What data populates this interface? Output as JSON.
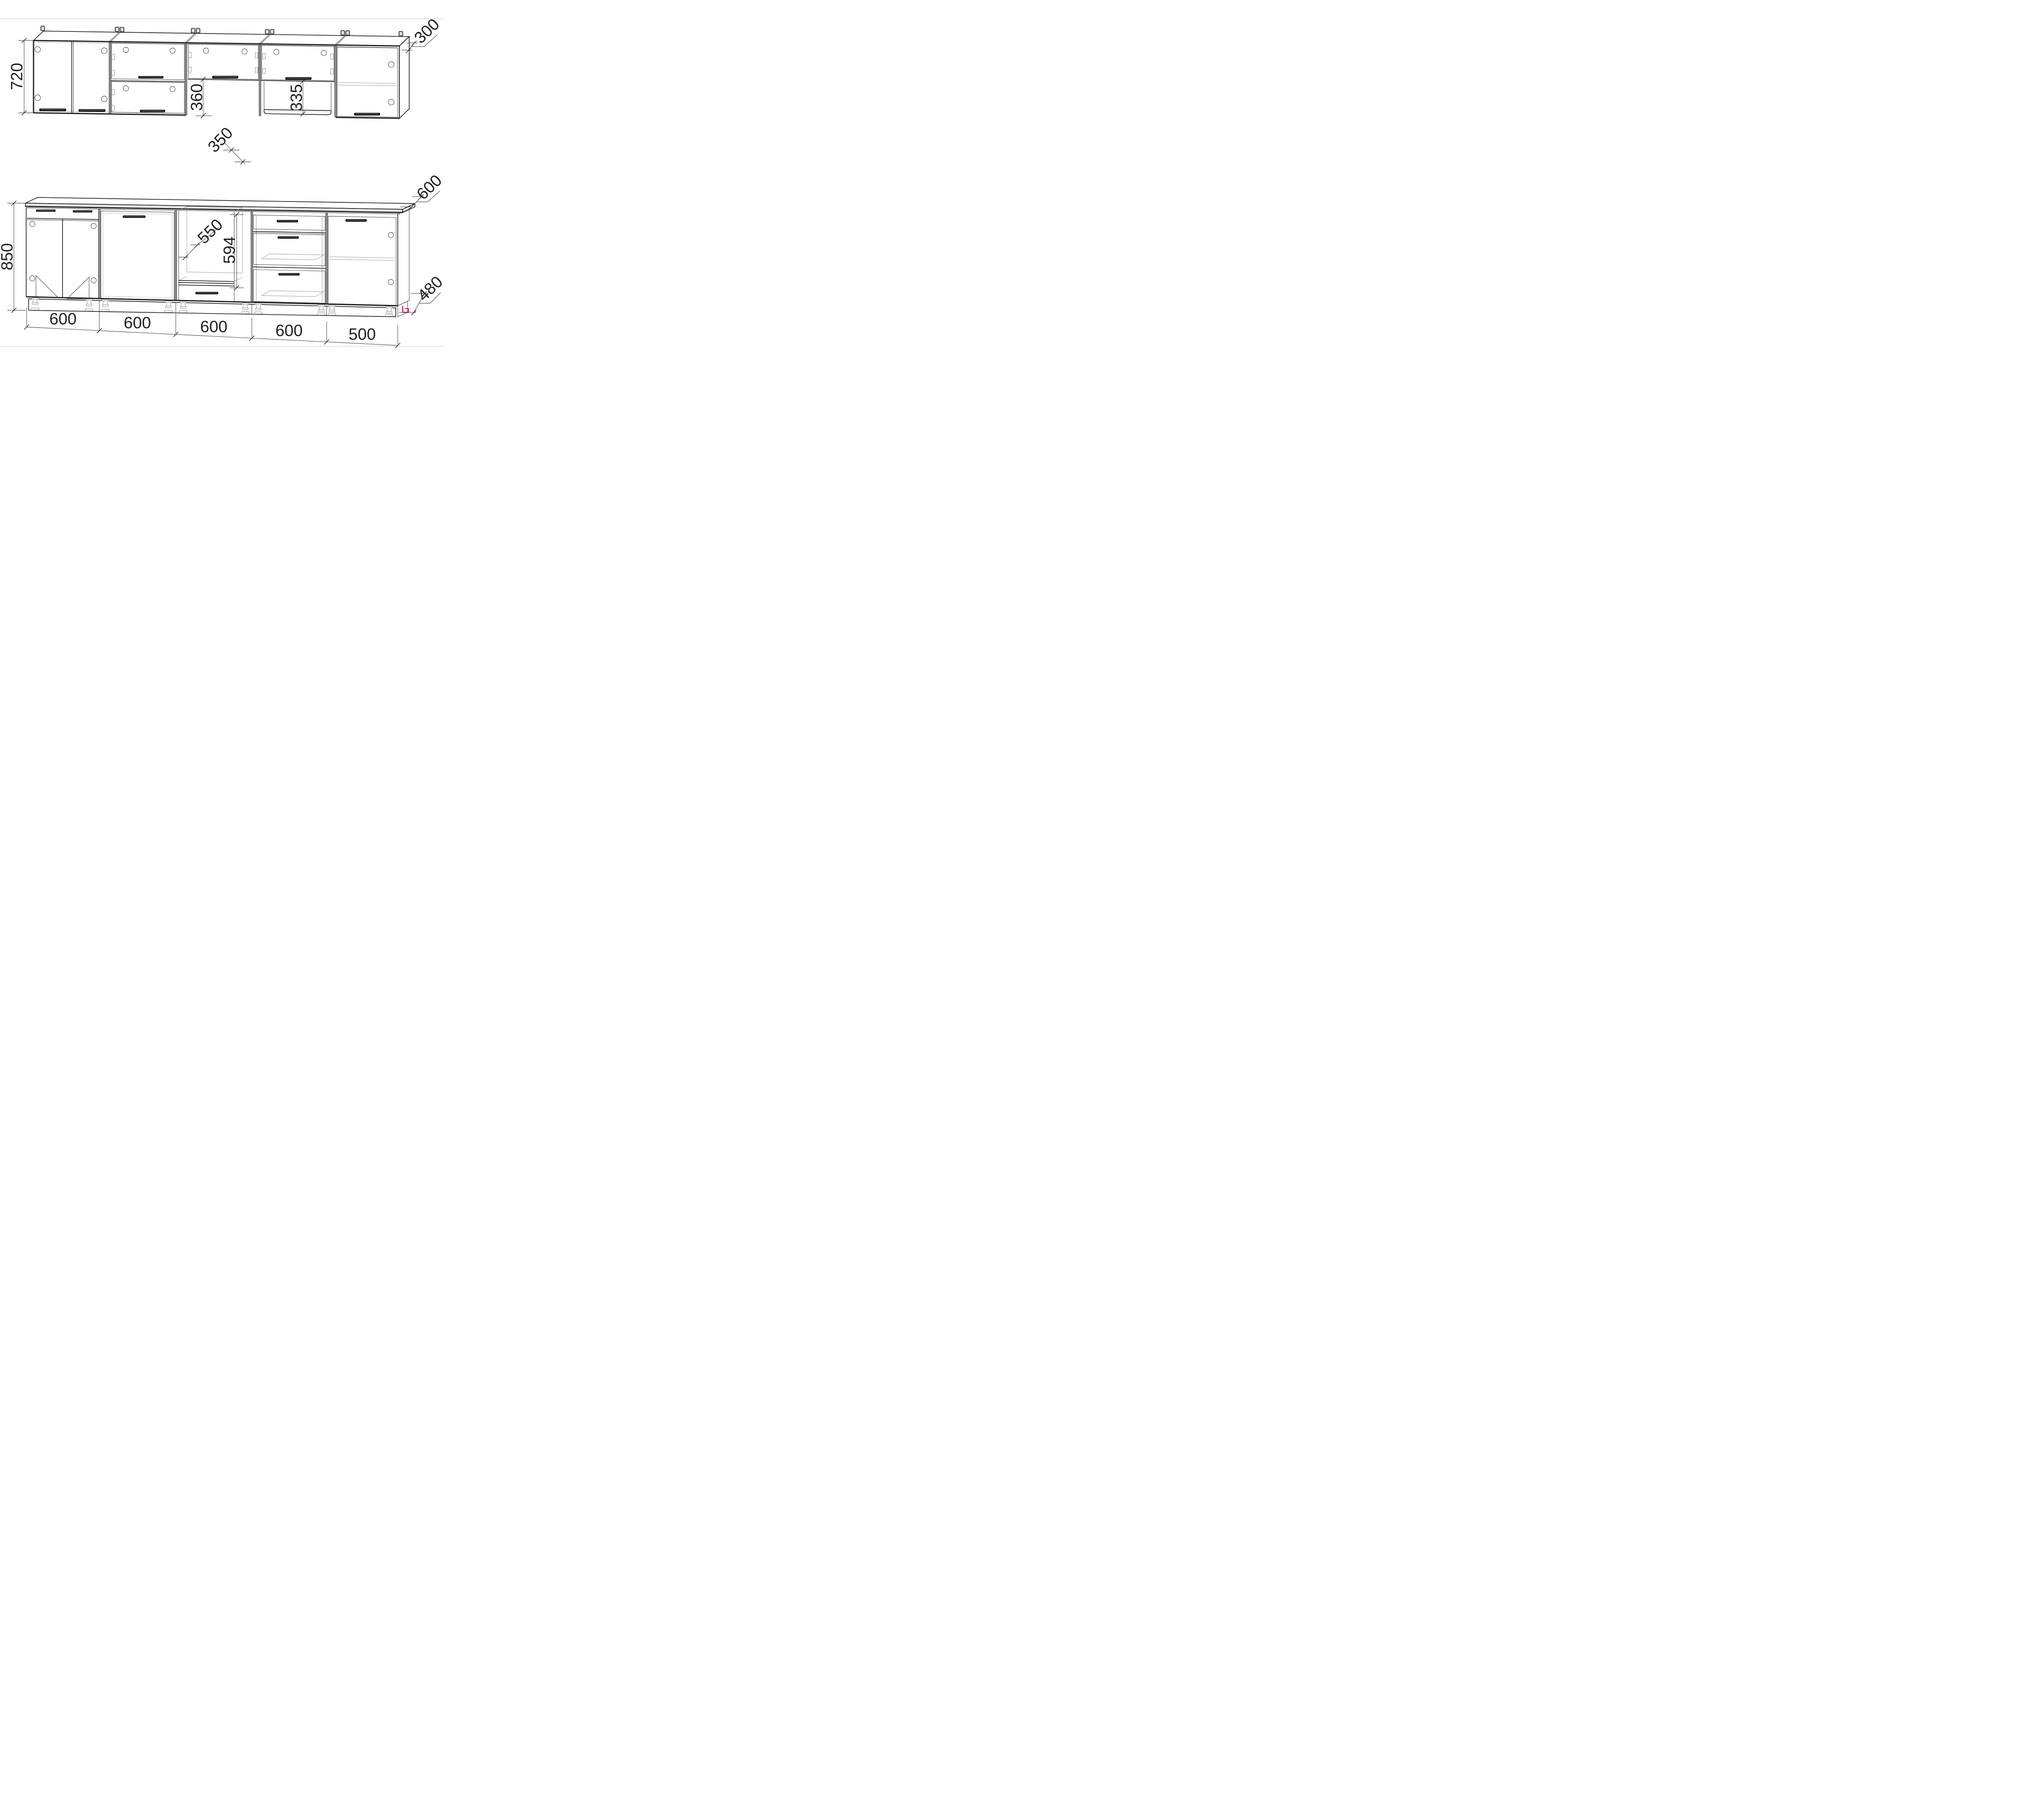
{
  "page": {
    "background": "#ffffff",
    "border_color": "#cdd2d8"
  },
  "drawing": {
    "kind": "kitchen-cabinet-set-technical-drawing",
    "units": "mm",
    "colors": {
      "line": "#1e1e1e",
      "hardware_gray": "#8a8a8a",
      "accent_pink": "#e8136e"
    },
    "dimensions": {
      "wall_height": "720",
      "wall_depth": "300",
      "hood_gap": "360",
      "hood_shelf_depth": "350",
      "open_niche_height": "335",
      "base_height": "850",
      "countertop_depth": "600",
      "oven_niche_width": "550",
      "oven_niche_height": "594",
      "plinth_depth": "480",
      "unit_widths": [
        "600",
        "600",
        "600",
        "600",
        "500"
      ]
    }
  }
}
